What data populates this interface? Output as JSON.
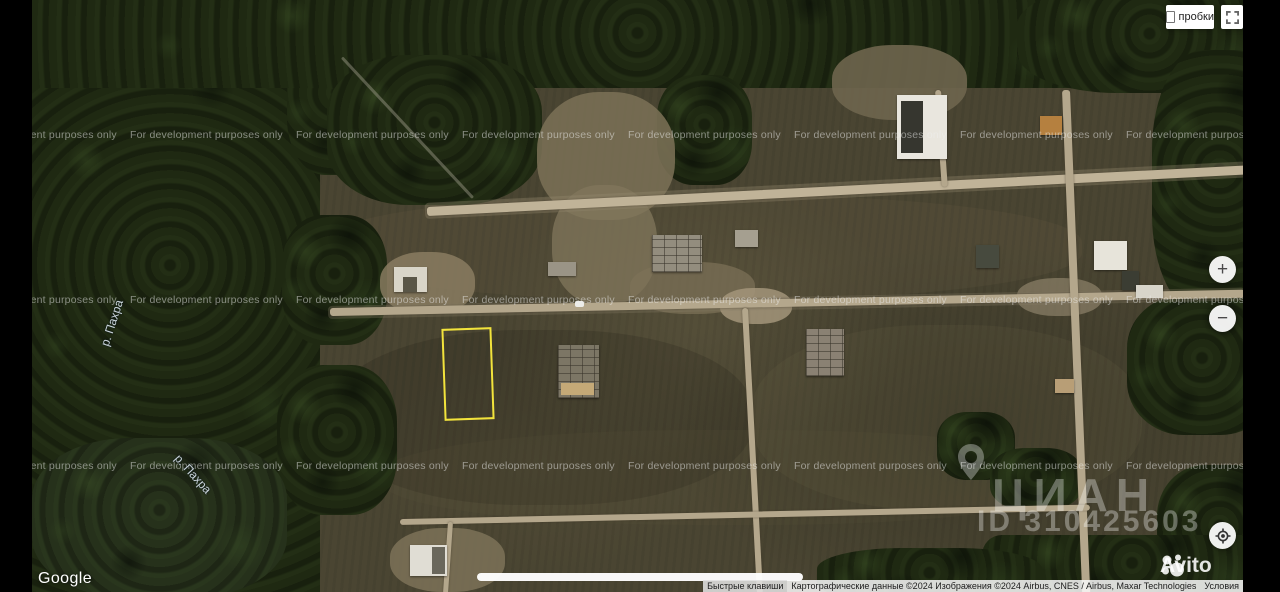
{
  "controls": {
    "traffic_label": "пробки",
    "traffic_checked": false,
    "zoom_in_label": "+",
    "zoom_out_label": "−"
  },
  "map": {
    "dev_watermark": "For development purposes only",
    "river_label": "р. Пахра",
    "google_logo": "Google",
    "listing": {
      "brand": "ЦИАН",
      "listing_id": "ID 310425603",
      "marketplace": "Avito"
    },
    "attribution": {
      "shortcuts": "Быстрые клавиши",
      "map_data": "Картографические данные ©2024 Изображения ©2024 Airbus, CNES / Airbus, Maxar Technologies",
      "terms": "Условия"
    }
  },
  "colors": {
    "plot_outline": "#f2e33c",
    "field": "#4a4532",
    "forest": "#1f2912",
    "road": "#b4a78c",
    "watermark_text": "rgba(240,240,240,0.5)",
    "cian_watermark": "rgba(255,255,255,0.33)"
  }
}
